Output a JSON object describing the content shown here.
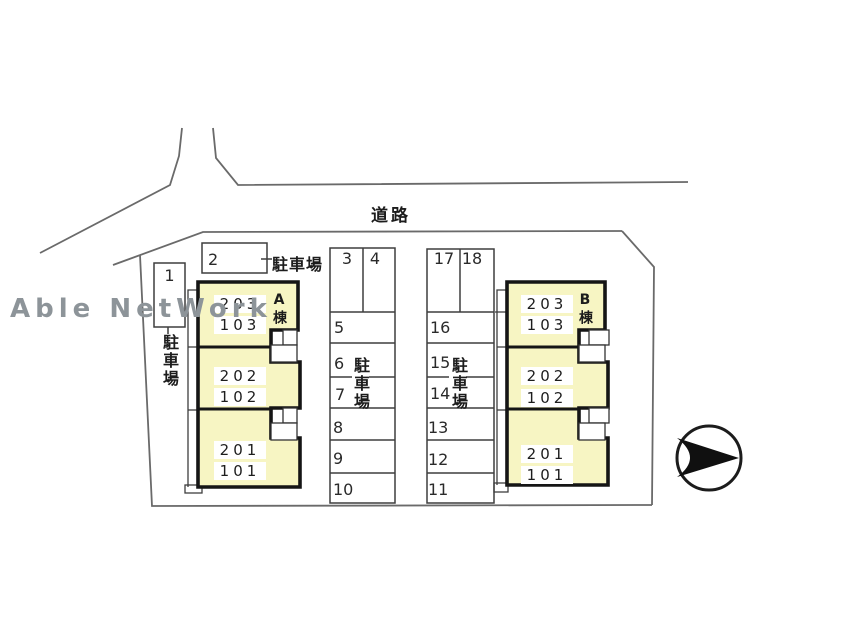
{
  "watermark": {
    "text": "Able NetWork",
    "color": "#8d9499"
  },
  "road": {
    "label": "道路"
  },
  "parking": {
    "area_label": "駐車場",
    "stalls": [
      "1",
      "2",
      "3",
      "4",
      "5",
      "6",
      "7",
      "8",
      "9",
      "10",
      "11",
      "12",
      "13",
      "14",
      "15",
      "16",
      "17",
      "18"
    ]
  },
  "buildings": [
    {
      "name": "A棟",
      "fill": "#f7f5c3",
      "units": [
        [
          "203",
          "103"
        ],
        [
          "202",
          "102"
        ],
        [
          "201",
          "101"
        ]
      ]
    },
    {
      "name": "B棟",
      "fill": "#f7f5c3",
      "units": [
        [
          "203",
          "103"
        ],
        [
          "202",
          "102"
        ],
        [
          "201",
          "101"
        ]
      ]
    }
  ]
}
